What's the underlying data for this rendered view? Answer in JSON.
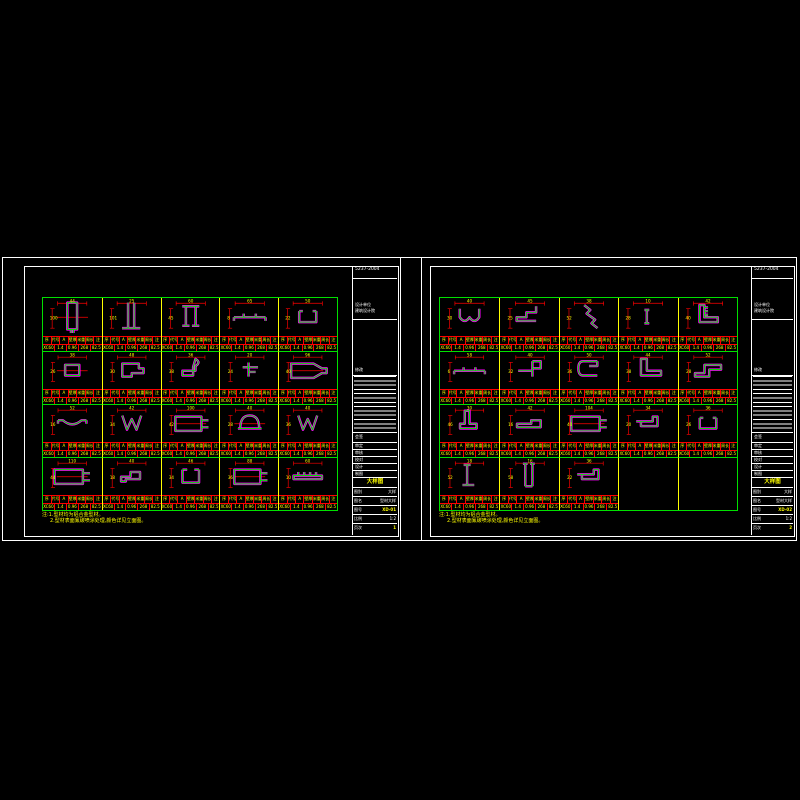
{
  "colors": {
    "bg": "#000000",
    "frame": "#ffffff",
    "grid_green": "#00e000",
    "divider_yellow": "#ffff00",
    "dim_red": "#ff0000",
    "profile_green": "#00e000",
    "profile_magenta": "#ff00ff",
    "text_yellow": "#ffff00",
    "text_white": "#ffffff"
  },
  "table": {
    "row1": [
      "序",
      "代号",
      "A",
      "壁厚",
      "米重",
      "周长",
      "注"
    ],
    "row2": [
      "XC60",
      "1.4",
      "0.96",
      "268",
      "82.5"
    ]
  },
  "sheets": [
    {
      "id": "left",
      "notes": {
        "n1": "注:1.型材均为铝合金型材。",
        "n2": "2.型材表面氟碳喷涂处理,颜色详见立面图。"
      },
      "titleblock": {
        "std": "5237-2004",
        "firm1": "设计单位",
        "firm2": "建筑设计院",
        "rev_label": "修改",
        "sign_label": "会签",
        "roles": [
          "审定",
          "审核",
          "校对",
          "设计",
          "制图"
        ],
        "stage": "大样图",
        "rows": [
          {
            "label": "图别",
            "value": "大样"
          },
          {
            "label": "图名",
            "value": "型材大样"
          },
          {
            "label": "图号",
            "value": "XD-01"
          },
          {
            "label": "比例",
            "value": "1:2"
          },
          {
            "label": "页次",
            "value": "1"
          }
        ]
      },
      "cells": [
        {
          "shape": "tube-v",
          "dims": [
            "44",
            "100"
          ]
        },
        {
          "shape": "i-tall",
          "dims": [
            "25",
            "101"
          ]
        },
        {
          "shape": "h-sec",
          "dims": [
            "60",
            "45"
          ]
        },
        {
          "shape": "flat-tab",
          "dims": [
            "65",
            "8"
          ]
        },
        {
          "shape": "u-chan",
          "dims": [
            "50",
            "22"
          ]
        },
        {
          "shape": "rect-sm",
          "dims": [
            "38",
            "26"
          ]
        },
        {
          "shape": "step-f",
          "dims": [
            "48",
            "30"
          ]
        },
        {
          "shape": "j-hook",
          "dims": [
            "36",
            "38"
          ]
        },
        {
          "shape": "t-sm",
          "dims": [
            "20",
            "24"
          ]
        },
        {
          "shape": "tube-nozzle",
          "dims": [
            "96",
            "40"
          ]
        },
        {
          "shape": "arc-shallow",
          "dims": [
            "52",
            "16"
          ]
        },
        {
          "shape": "w-zig",
          "dims": [
            "42",
            "34"
          ]
        },
        {
          "shape": "tube-h-tab",
          "dims": [
            "100",
            "42"
          ]
        },
        {
          "shape": "dome",
          "dims": [
            "40",
            "28"
          ]
        },
        {
          "shape": "w-zig",
          "dims": [
            "40",
            "36"
          ]
        },
        {
          "shape": "long-tube",
          "dims": [
            "110",
            "44"
          ]
        },
        {
          "shape": "step-sm",
          "dims": [
            "40",
            "18"
          ]
        },
        {
          "shape": "u-lip",
          "dims": [
            "46",
            "34"
          ]
        },
        {
          "shape": "tube-h-tab",
          "dims": [
            "88",
            "36"
          ]
        },
        {
          "shape": "bar-ridge",
          "dims": [
            "60",
            "10"
          ]
        }
      ]
    },
    {
      "id": "right",
      "notes": {
        "n1": "注:1.型材均为铝合金型材。",
        "n2": "2.型材表面氟碳喷涂处理,颜色详见立面图。"
      },
      "titleblock": {
        "std": "5237-2004",
        "firm1": "设计单位",
        "firm2": "建筑设计院",
        "rev_label": "修改",
        "sign_label": "会签",
        "roles": [
          "审定",
          "审核",
          "校对",
          "设计",
          "制图"
        ],
        "stage": "大样图",
        "rows": [
          {
            "label": "图别",
            "value": "大样"
          },
          {
            "label": "图名",
            "value": "型材大样"
          },
          {
            "label": "图号",
            "value": "XD-02"
          },
          {
            "label": "比例",
            "value": "1:2"
          },
          {
            "label": "页次",
            "value": "2"
          }
        ]
      },
      "cells": [
        {
          "shape": "u-wavy",
          "dims": [
            "40",
            "30"
          ]
        },
        {
          "shape": "l-step",
          "dims": [
            "45",
            "25"
          ]
        },
        {
          "shape": "diag-zig",
          "dims": [
            "38",
            "52"
          ]
        },
        {
          "shape": "bar-v-sm",
          "dims": [
            "10",
            "28"
          ]
        },
        {
          "shape": "corner-teeth",
          "dims": [
            "42",
            "40"
          ]
        },
        {
          "shape": "flat-tab",
          "dims": [
            "58",
            "6"
          ]
        },
        {
          "shape": "flag-l",
          "dims": [
            "40",
            "32"
          ]
        },
        {
          "shape": "c-hook",
          "dims": [
            "50",
            "36"
          ]
        },
        {
          "shape": "l-thick",
          "dims": [
            "44",
            "38"
          ]
        },
        {
          "shape": "z-step",
          "dims": [
            "52",
            "28"
          ]
        },
        {
          "shape": "j-foot",
          "dims": [
            "30",
            "46"
          ]
        },
        {
          "shape": "low-step",
          "dims": [
            "42",
            "16"
          ]
        },
        {
          "shape": "long-tube",
          "dims": [
            "104",
            "40"
          ]
        },
        {
          "shape": "hook-sm",
          "dims": [
            "34",
            "20"
          ]
        },
        {
          "shape": "u-chan",
          "dims": [
            "36",
            "26"
          ]
        },
        {
          "shape": "i-feet",
          "dims": [
            "18",
            "52"
          ]
        },
        {
          "shape": "tall-u",
          "dims": [
            "16",
            "58"
          ]
        },
        {
          "shape": "hook-sm",
          "dims": [
            "36",
            "22"
          ]
        },
        {
          "shape": "",
          "dims": []
        },
        {
          "shape": "",
          "dims": []
        }
      ]
    }
  ]
}
